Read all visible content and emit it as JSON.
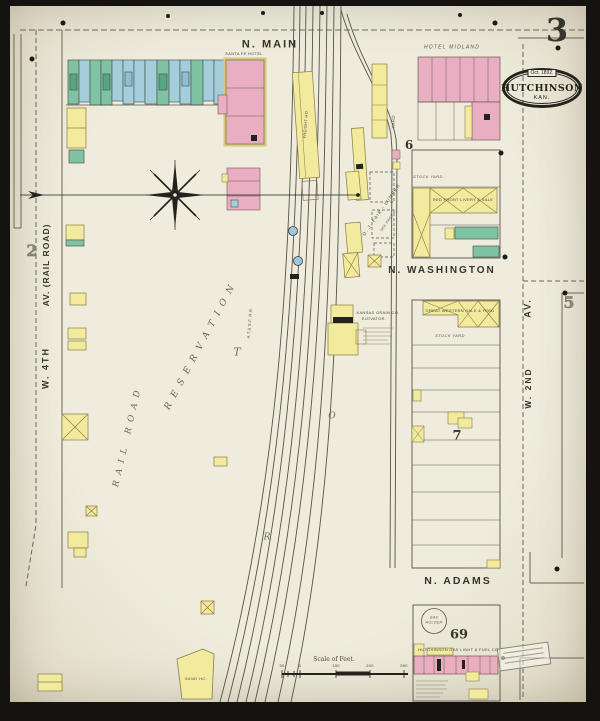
{
  "sheet": {
    "page_number": "3",
    "stamp": {
      "date": "Oct. 1892.",
      "city": "HUTCHINSON",
      "state": "KAN."
    }
  },
  "streets": {
    "n_main": "N. MAIN",
    "n_washington": "N. WASHINGTON",
    "n_adams": "N. ADAMS",
    "av_railroad": "AV. (RAIL ROAD)",
    "w_4th": "W. 4TH",
    "av_east": "AV.",
    "w_2nd": "W. 2ND"
  },
  "block_numbers": {
    "two": "2",
    "five": "5",
    "six": "6",
    "seven": "7",
    "sixty_nine": "69"
  },
  "buildings": {
    "santa_fe_hotel": "SANTA FE HOTEL",
    "hotel_midland": "HOTEL MIDLAND",
    "freight_house": "FREIGHT HO.",
    "yard": "YARD",
    "stock_yard_block6": "STOCK YARD",
    "red_front_livery": "RED FRONT LIVERY & SALE",
    "great_western": "GREAT WESTERN SALE & FEED",
    "stock_yard_block7": "STOCK YARD",
    "grain_co_line1": "KANSAS GRAIN CO.",
    "grain_co_line2": "ELEVATOR.",
    "lumber_yard": "D. J. FAIR - LUMBER",
    "lumber_note": "SEE PAGE 4.",
    "gas_works": "HUTCHINSON GAS LIGHT & FUEL CO.",
    "gas_holder_line1": "GAS",
    "gas_holder_line2": "HOLDER",
    "sand_house": "SAND HO.",
    "railroad_name": "A.T.& S.F. R.R."
  },
  "open_space": {
    "line1": "RAIL ROAD",
    "line2": "RESERVATION",
    "stray_letters": [
      "T",
      "R",
      "O"
    ]
  },
  "scale_bar": {
    "title": "Scale of Feet.",
    "ticks": [
      "50",
      "0",
      "100",
      "200",
      "300"
    ]
  },
  "map_colors": {
    "brick_pink": "#e9aec1",
    "frame_yellow": "#f2ea9d",
    "stone_blue": "#a5cedd",
    "special_green": "#7fc3a3",
    "paper": "#ece8d9",
    "ink": "#3c3a31"
  }
}
